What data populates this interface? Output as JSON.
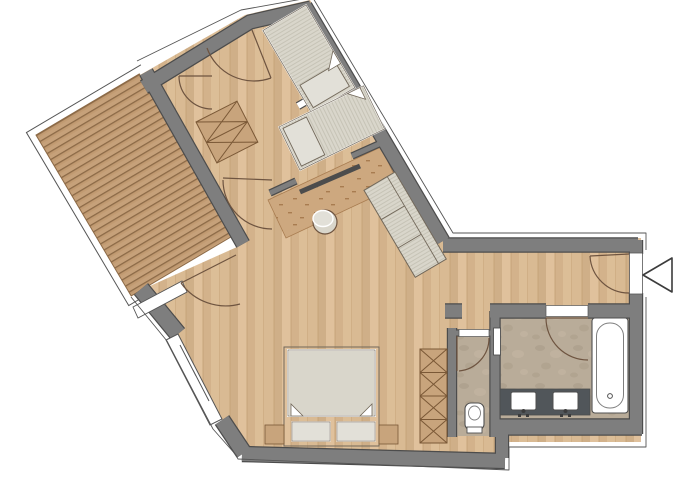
{
  "meta": {
    "kind": "architectural-floor-plan",
    "view": "top-down",
    "text_labels_visible": "none"
  },
  "colors": {
    "page_bg": "#ffffff",
    "wall_fill": "#7e7e7e",
    "wall_edge": "#4c4c4c",
    "outline": "#555555",
    "wood_base": "#d9ba93",
    "wood_s1": "#cfaf88",
    "wood_s2": "#e0c19c",
    "wood_s3": "#d3b28b",
    "wood_line": "#c3a075",
    "deck_base": "#c19a71",
    "deck_line": "#8c6a47",
    "stone_base": "#b9ac99",
    "stone_m1": "#ab9e8a",
    "stone_m2": "#c3b6a2",
    "rug_base": "#cda87f",
    "rug_dot": "#a87c50",
    "fab_fill": "#d9d6cb",
    "fab_stripe": "#c6c3b6",
    "fab_edge": "#72685a",
    "white": "#ffffff",
    "pillow_fill": "#e2e0d8",
    "tan_fill": "#c8a47c",
    "tan_line": "#7a5836",
    "vanity_dark": "#51565a",
    "fixture_edge": "#4f4f4f",
    "door_arc": "#6e5440",
    "arrow_edge": "#3c3c3c",
    "glass_white": "#ffffff"
  },
  "rooms": [
    {
      "name": "terrace-deck"
    },
    {
      "name": "hallway"
    },
    {
      "name": "bedroom-1"
    },
    {
      "name": "bedroom-2"
    },
    {
      "name": "living-area"
    },
    {
      "name": "sleeping-area"
    },
    {
      "name": "entry-corridor"
    },
    {
      "name": "wc"
    },
    {
      "name": "bathroom"
    }
  ],
  "fixtures": [
    "single-bed-with-pillow-1",
    "single-bed-with-pillow-2",
    "double-bed-two-pillows",
    "sofa-three-seats",
    "round-stool",
    "area-rug",
    "x-wardrobe-hallway",
    "x-shelf-column",
    "toilet",
    "vanity-two-sinks-faucets",
    "bathtub-with-drain",
    "wall-radiator",
    "sliding-partition-door"
  ],
  "doors": [
    "bedroom-door-1",
    "bedroom-door-2",
    "hallway-living-door",
    "terrace-door",
    "entrance-door",
    "bathroom-door",
    "wc-door"
  ],
  "windows": [
    "terrace-railing",
    "large-sliding-window-southwest",
    "glass-partition-beds"
  ],
  "entrance_marker": {
    "shape": "triangle-arrow",
    "direction": "pointing-left-into-entrance"
  }
}
